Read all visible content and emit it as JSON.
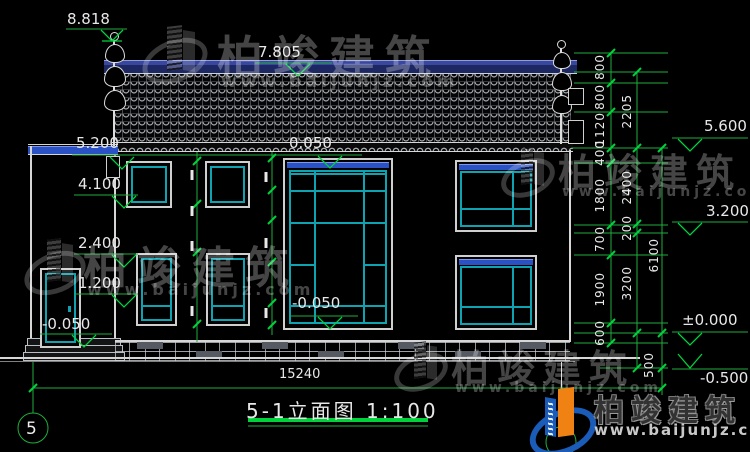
{
  "drawing": {
    "title": "5-1立面图 1:100",
    "axis_bubble_left": "5",
    "overall_width_dim": "15240"
  },
  "levels": {
    "finial_top": "8.818",
    "ridge": "7.805",
    "wing_roof": "5.200",
    "upper_window_sill": "4.100",
    "mid_level": "2.400",
    "lower_window_mid": "1.200",
    "wing_floor": "-0.050",
    "second_floor_head": "0.050",
    "entrance_floor": "-0.050",
    "eave_right": "5.600",
    "mid_right": "3.200",
    "ground_zero": "±0.000",
    "outdoor_ground": "-0.500"
  },
  "dims": {
    "chain_inner": [
      "800",
      "800",
      "1120",
      "400",
      "1800",
      "700",
      "1900",
      "600"
    ],
    "chain_mid": [
      "2205",
      "2400",
      "200",
      "3200",
      "500"
    ],
    "chain_outer": [
      "6100"
    ]
  },
  "watermark": {
    "brand": "柏竣建筑",
    "url": "www.baijunjz.com"
  }
}
